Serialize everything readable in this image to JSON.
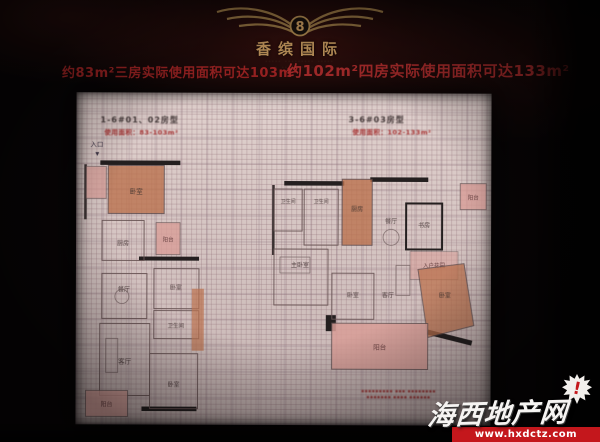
{
  "header": {
    "brand": "香缤国际",
    "brand_sub1": "····· ········· ·····",
    "brand_sub2": "· ···· ······ ·",
    "monogram": "8"
  },
  "headlines": {
    "left": "约83m²三房实际使用面积可达103m²",
    "right": "约102m²四房实际使用面积可达133m²"
  },
  "plans": {
    "left": {
      "unit_label": "1-6#01、02房型",
      "area_note": "使用面积：83-103m²",
      "entrance_label": "入口",
      "entrance_arrow": "▼",
      "rooms": [
        "卧室",
        "厨房",
        "阳台",
        "餐厅",
        "卧室",
        "卫生间",
        "客厅",
        "卧室",
        "阳台"
      ]
    },
    "right": {
      "unit_label": "3-6#03房型",
      "area_note": "使用面积：102-133m²",
      "rooms": [
        "卫生间",
        "卫生间",
        "厨房",
        "餐厅",
        "阳台",
        "书房",
        "入户花园",
        "主卧室",
        "卧室",
        "客厅",
        "卧室",
        "阳台"
      ]
    },
    "disclaimer_line1": "▪▪▪▪▪▪▪▪▪ ▪▪▪ ▪▪▪▪▪▪▪▪",
    "disclaimer_line2": "▪▪▪▪▪▪▪ ▪▪▪▪ ▪▪▪▪▪▪"
  },
  "watermark": {
    "site_name": "海西地产网",
    "url": "www.hxdctz.com",
    "badge": "!"
  },
  "colors": {
    "headline_red": "#a32424",
    "brand_gold": "#c79a5f",
    "paper": "#d7c6c4",
    "room_orange": "#c0714a",
    "room_pink": "#dd9d96",
    "watermark_red": "#c4171c"
  }
}
